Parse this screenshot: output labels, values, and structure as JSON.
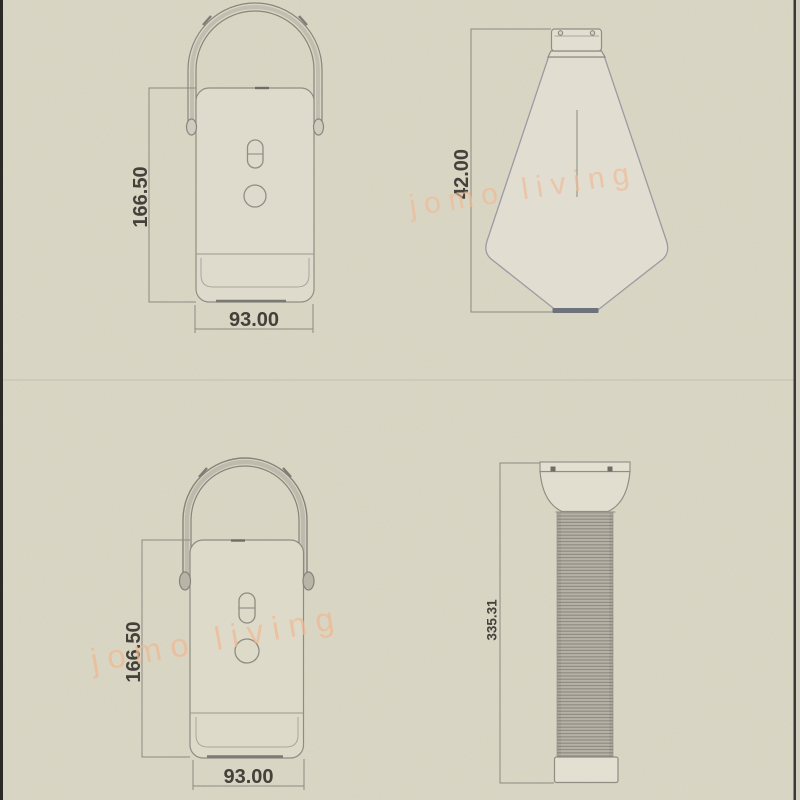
{
  "palette": {
    "background": "#dbd7c5",
    "line": "#8f8d84",
    "handle_line": "#87857d",
    "shade_line": "#9c9aa4",
    "text": "#44403a",
    "watermark": "#f0b992",
    "panel_fill": "#e1ddd0",
    "column_fill": "#b6b2a8",
    "column_stripe": "#8e8a80",
    "dark_accent": "#6d727b",
    "divider": "#c3c0b2"
  },
  "watermark": {
    "text": "jomo living"
  },
  "views": {
    "top_front": {
      "height_label": "166.50",
      "width_label": "93.00"
    },
    "top_side": {
      "height_label": "42.00"
    },
    "bottom_front": {
      "height_label": "166.50",
      "width_label": "93.00"
    },
    "bottom_side": {
      "height_label": "335.31"
    }
  }
}
